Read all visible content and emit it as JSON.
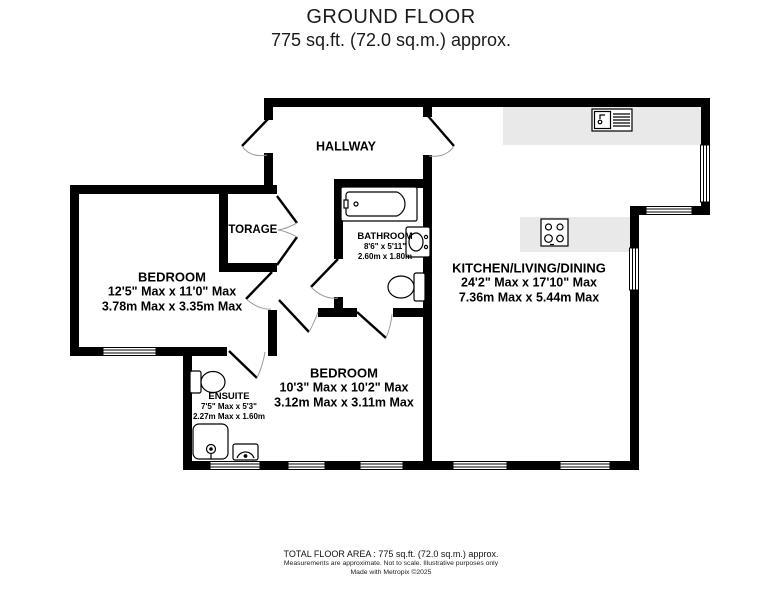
{
  "title": {
    "line1": "GROUND FLOOR",
    "line2": "775 sq.ft. (72.0 sq.m.) approx."
  },
  "rooms": {
    "hallway": {
      "name": "HALLWAY"
    },
    "storage": {
      "name": "STORAGE"
    },
    "bathroom": {
      "name": "BATHROOM",
      "imperial": "8'6\" x 5'11\"",
      "metric": "2.60m x 1.80m"
    },
    "bedroom1": {
      "name": "BEDROOM",
      "imperial": "12'5\" Max x 11'0\" Max",
      "metric": "3.78m Max x 3.35m Max"
    },
    "kitchen": {
      "name": "KITCHEN/LIVING/DINING",
      "imperial": "24'2\" Max x 17'10\" Max",
      "metric": "7.36m Max x 5.44m Max"
    },
    "bedroom2": {
      "name": "BEDROOM",
      "imperial": "10'3\" Max x 10'2\" Max",
      "metric": "3.12m Max x 3.11m Max"
    },
    "ensuite": {
      "name": "ENSUITE",
      "imperial": "7'5\" Max x 5'3\"",
      "metric": "2.27m Max x 1.60m"
    }
  },
  "footer": {
    "line1": "TOTAL FLOOR AREA : 775 sq.ft. (72.0 sq.m.) approx.",
    "line2": "Measurements are approximate.  Not to scale.  Illustrative purposes only",
    "line3": "Made with Metropix ©2025"
  },
  "colors": {
    "wall": "#000000",
    "counter": "#e9e9e9",
    "door_arc": "#9a9a9a"
  }
}
